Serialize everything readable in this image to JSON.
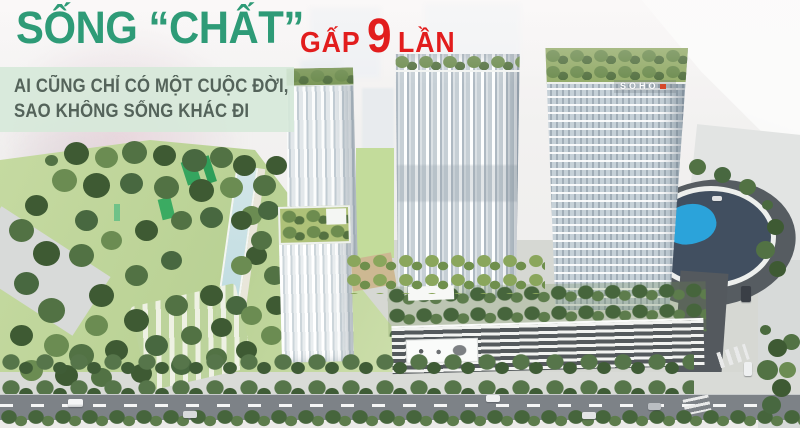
{
  "headline": {
    "main": "SỐNG “CHẤT”",
    "sub": {
      "prefix": "GẤP",
      "number": "9",
      "suffix": "LẦN"
    }
  },
  "tagline": {
    "line1": "AI CŨNG CHỈ CÓ MỘT CUỘC ĐỜI,",
    "line2": "SAO KHÔNG SỐNG KHÁC ĐI"
  },
  "buildings": {
    "tower_sign": "SOHO"
  },
  "colors": {
    "headline_green": "#2E9B77",
    "accent_red": "#E21D1D",
    "tagline_bg": "#D6E9D9",
    "tagline_text": "#54635A"
  }
}
